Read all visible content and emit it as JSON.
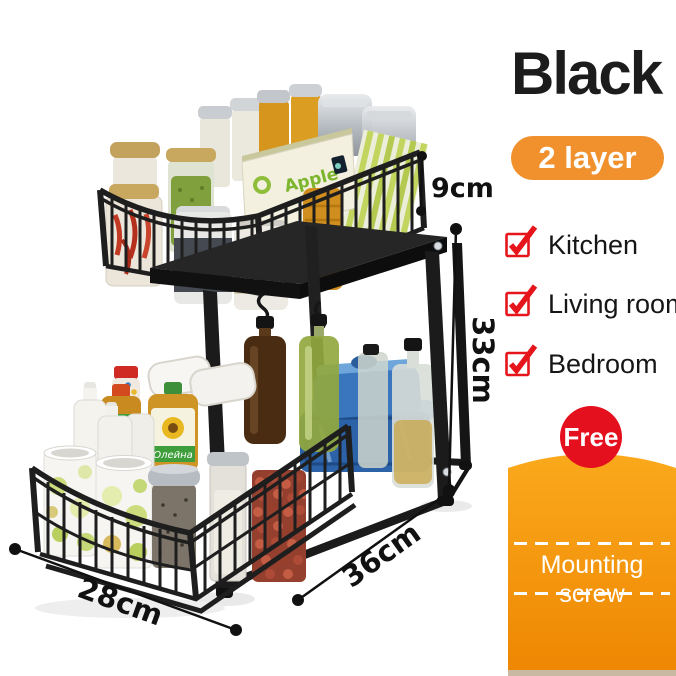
{
  "panel": {
    "color_title": "Black",
    "layer_badge": "2 layer",
    "rooms": [
      "Kitchen",
      "Living room",
      "Bedroom"
    ],
    "free_badge": "Free",
    "free_item": "Mounting screw"
  },
  "dimensions": {
    "tier_height": "9cm",
    "total_height": "33cm",
    "depth": "36cm",
    "width": "28cm"
  },
  "product_items": {
    "apple_box_label": "Apple",
    "oil_label": "Олейна"
  },
  "colors": {
    "accent_orange": "#F0912D",
    "orange_gradient_top": "#FBA91C",
    "orange_gradient_bottom": "#EE8602",
    "badge_red": "#E5101E",
    "check_red": "#E5151B",
    "text_black": "#1C1C1C"
  }
}
